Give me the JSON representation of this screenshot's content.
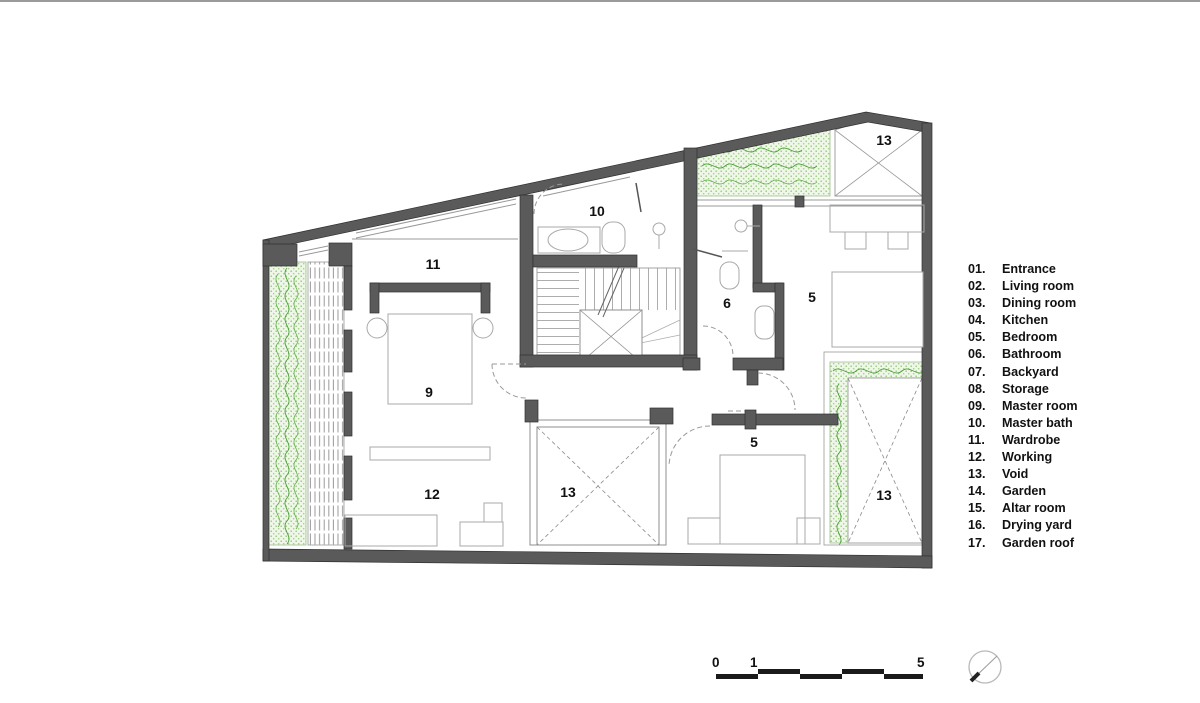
{
  "legend": {
    "items": [
      {
        "num": "01.",
        "label": "Entrance"
      },
      {
        "num": "02.",
        "label": "Living room"
      },
      {
        "num": "03.",
        "label": "Dining room"
      },
      {
        "num": "04.",
        "label": "Kitchen"
      },
      {
        "num": "05.",
        "label": "Bedroom"
      },
      {
        "num": "06.",
        "label": "Bathroom"
      },
      {
        "num": "07.",
        "label": "Backyard"
      },
      {
        "num": "08.",
        "label": "Storage"
      },
      {
        "num": "09.",
        "label": "Master room"
      },
      {
        "num": "10.",
        "label": "Master bath"
      },
      {
        "num": "11.",
        "label": "Wardrobe"
      },
      {
        "num": "12.",
        "label": "Working"
      },
      {
        "num": "13.",
        "label": "Void"
      },
      {
        "num": "14.",
        "label": "Garden"
      },
      {
        "num": "15.",
        "label": "Altar room"
      },
      {
        "num": "16.",
        "label": "Drying yard"
      },
      {
        "num": "17.",
        "label": "Garden roof"
      }
    ]
  },
  "plan": {
    "room_labels": [
      {
        "text": "10"
      },
      {
        "text": "13"
      },
      {
        "text": "11"
      },
      {
        "text": "6"
      },
      {
        "text": "5"
      },
      {
        "text": "9"
      },
      {
        "text": "12"
      },
      {
        "text": "13"
      },
      {
        "text": "5"
      },
      {
        "text": "13"
      }
    ]
  },
  "scale_bar": {
    "labels": [
      "0",
      "1",
      "5"
    ]
  },
  "colors": {
    "wall": "#5a5a5a",
    "thin_line": "#999999",
    "furniture_line": "#a8a8a8",
    "garden_bg": "#eff7e9",
    "garden_dot": "#97c77c",
    "garden_scribble": "#4c9e3a",
    "text": "#111111"
  },
  "icons": {
    "north_indicator": "north-arrow-icon"
  }
}
